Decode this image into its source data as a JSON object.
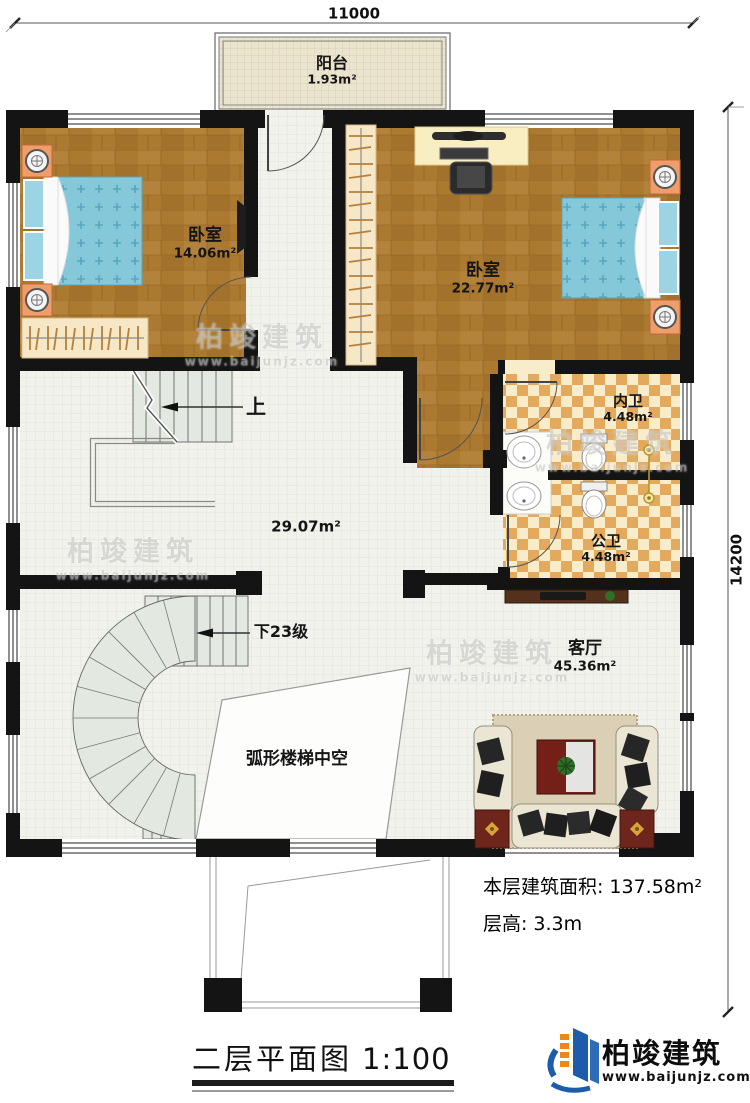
{
  "dimensions": {
    "top": "11000",
    "right": "14200"
  },
  "rooms": {
    "balcony": {
      "name": "阳台",
      "area": "1.93m²"
    },
    "bedroom_left": {
      "name": "卧室",
      "area": "14.06m²"
    },
    "bedroom_right": {
      "name": "卧室",
      "area": "22.77m²"
    },
    "bath_inner": {
      "name": "内卫",
      "area": "4.48m²"
    },
    "bath_public": {
      "name": "公卫",
      "area": "4.48m²"
    },
    "hall": {
      "area": "29.07m²"
    },
    "living_room": {
      "name": "客厅",
      "area": "45.36m²"
    }
  },
  "stairs": {
    "up": "上",
    "down": "下23级",
    "void_label": "弧形楼梯中空"
  },
  "info": {
    "area_label": "本层建筑面积:",
    "area_value": "137.58m²",
    "height_label": "层高:",
    "height_value": "3.3m"
  },
  "title": {
    "main": "二层平面图",
    "scale": "1:100"
  },
  "logo": {
    "name": "柏竣建筑",
    "url": "www.baijunjz.com"
  },
  "watermark": {
    "text": "柏竣建筑",
    "url": "www.baijunjz.com"
  }
}
